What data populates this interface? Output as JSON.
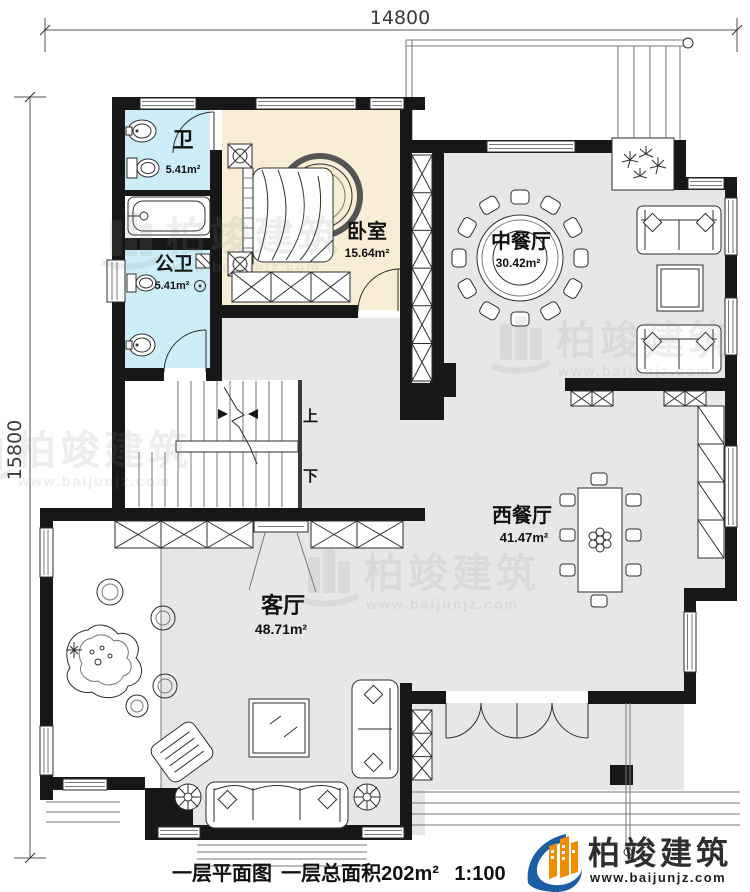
{
  "dimensions": {
    "top_width": "14800",
    "left_height": "15800"
  },
  "rooms": {
    "bath_top": {
      "name": "卫",
      "area": "5.41m²"
    },
    "bedroom": {
      "name": "卧室",
      "area": "15.64m²"
    },
    "bath_public": {
      "name": "公卫",
      "area": "5.41m²"
    },
    "dining_chinese": {
      "name": "中餐厅",
      "area": "30.42m²"
    },
    "dining_western": {
      "name": "西餐厅",
      "area": "41.47m²"
    },
    "living": {
      "name": "客厅",
      "area": "48.71m²"
    }
  },
  "stairs": {
    "up_label": "上",
    "down_label": "下"
  },
  "footer": {
    "plan_title": "一层平面图",
    "total_area": "一层总面积202m²",
    "scale": "1:100"
  },
  "brand": {
    "company": "柏竣建筑",
    "website": "www.baijunjz.com"
  },
  "watermark": {
    "company": "柏竣建筑",
    "website": "www.baijunjz.com"
  },
  "colors": {
    "wall": "#171717",
    "bath_floor": "#cdeef8",
    "bedroom_floor": "#f8eed6",
    "hall_floor": "#e7e7e7",
    "brand_blue": "#1b5ea6",
    "brand_orange": "#f08c00"
  }
}
